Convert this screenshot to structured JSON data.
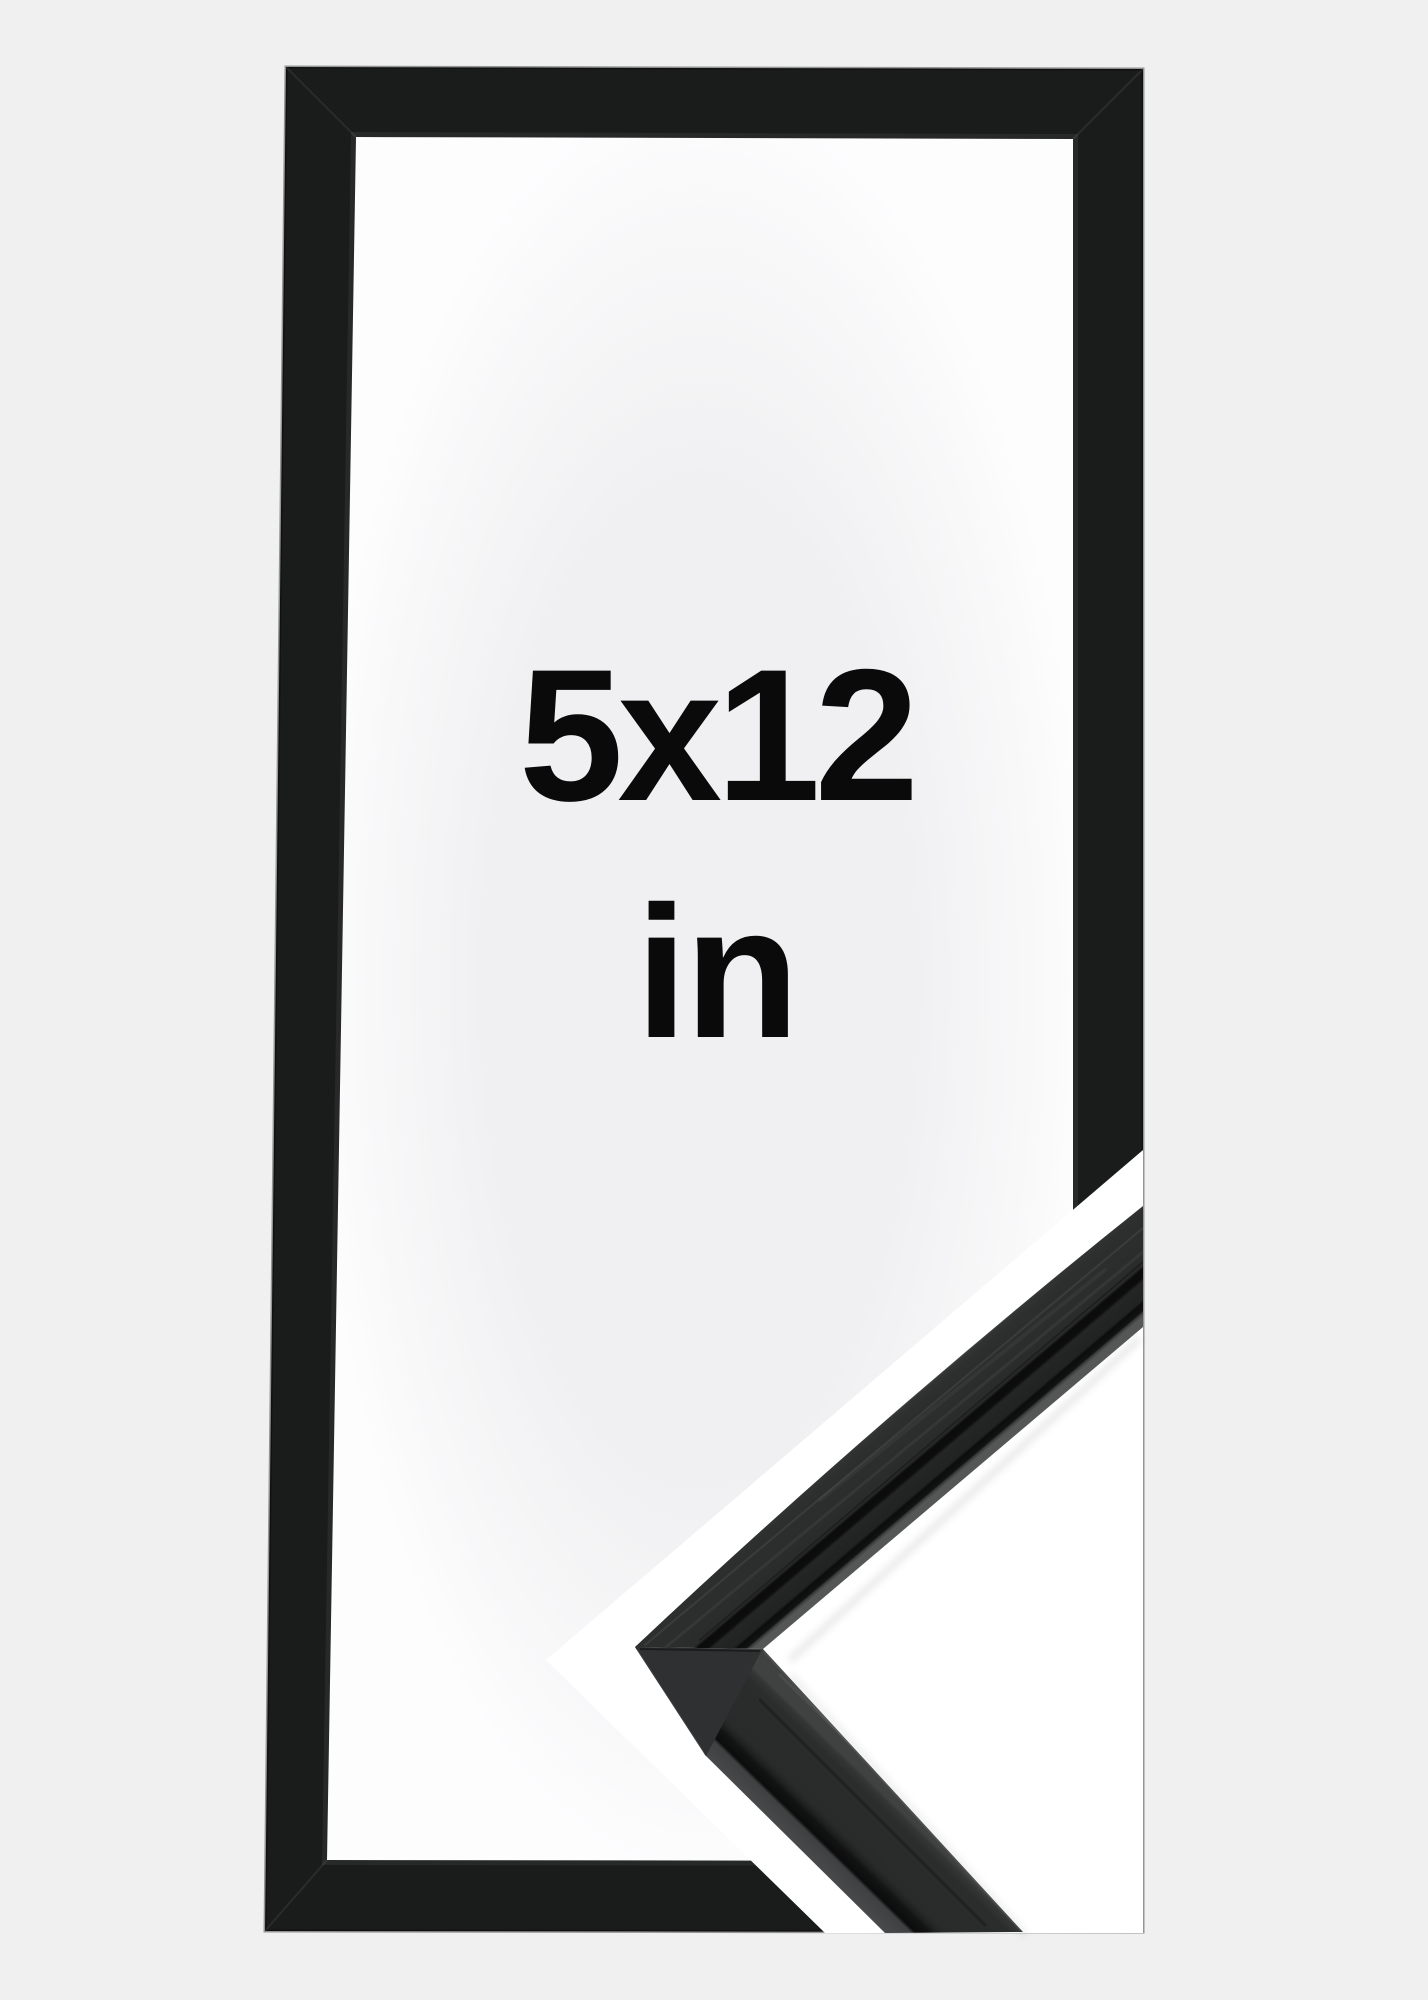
{
  "size_label": {
    "dimensions": "5x12",
    "unit": "in"
  },
  "colors": {
    "page_background": "#f0f0f1",
    "frame_black": "#1a1b1b",
    "text": "#0a0a0a",
    "detail_background": "#ffffff",
    "moulding_top_dark": "#2b2d2d",
    "moulding_side_face": "#47494b",
    "moulding_groove": "#0c0c0c"
  }
}
